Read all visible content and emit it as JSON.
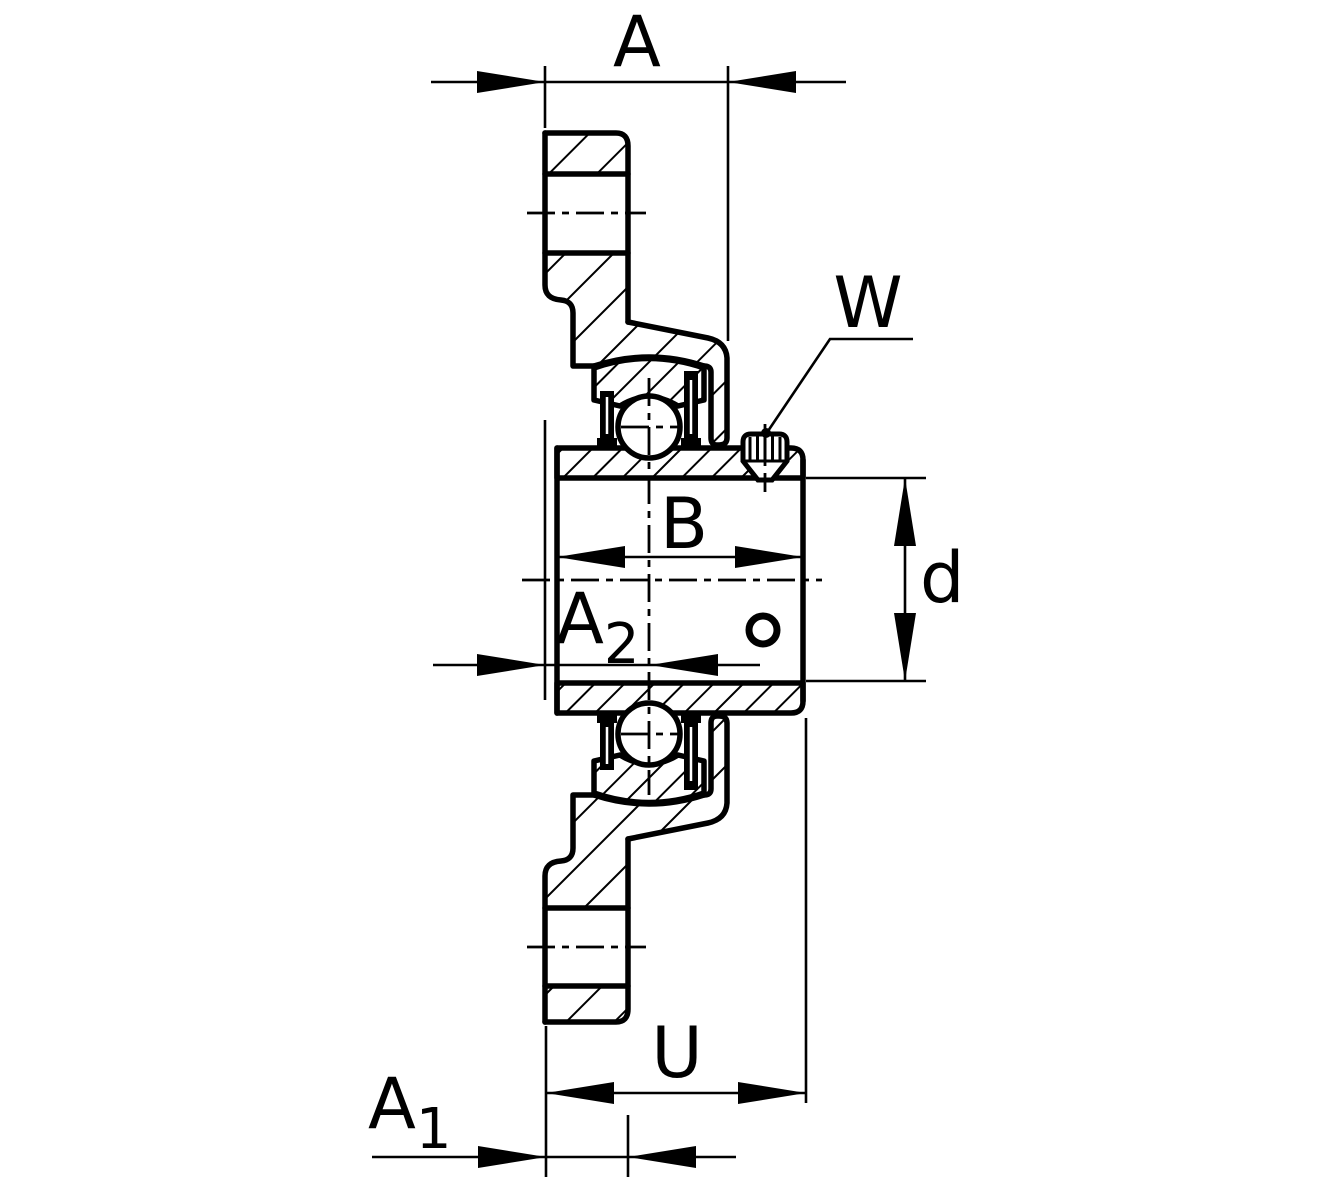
{
  "drawing": {
    "labels": {
      "a": "A",
      "a1_base": "A",
      "a1_sub": "1",
      "a2_base": "A",
      "a2_sub": "2",
      "b": "B",
      "d": "d",
      "u": "U",
      "w": "W"
    },
    "colors": {
      "line": "#000000",
      "background": "#ffffff"
    }
  }
}
